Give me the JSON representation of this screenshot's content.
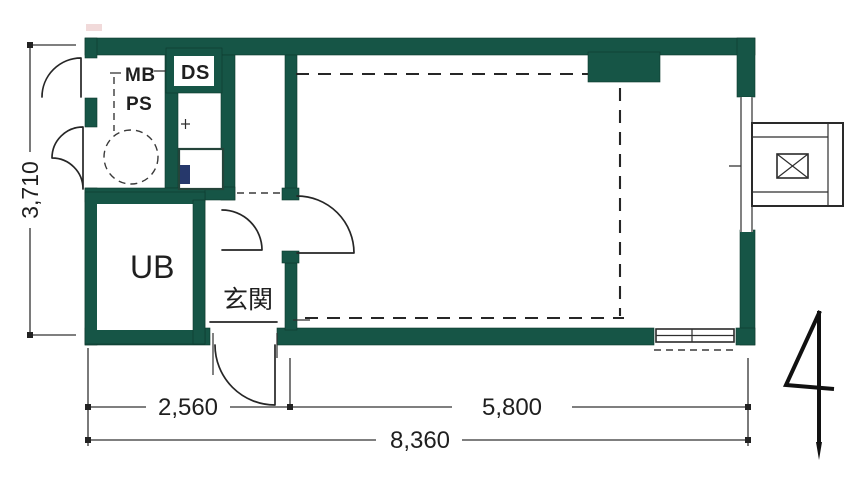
{
  "meta": {
    "type": "floor-plan",
    "description": "Scanned Japanese one-room apartment floor plan with green walls, dimension lines and north arrow"
  },
  "labels": {
    "meter_box": "MB",
    "pipe_space": "PS",
    "duct_space": "DS",
    "unit_bath": "UB",
    "entrance": "玄関"
  },
  "dimensions": {
    "left_height": "3,710",
    "bottom_left": "2,560",
    "bottom_right": "5,800",
    "bottom_total": "8,360"
  },
  "icons": {
    "north_arrow": "north-arrow",
    "ac_unit": "crossed-box",
    "toilet": "dashed-circle"
  },
  "colors": {
    "wall": "#165546",
    "line": "#262626",
    "fixture_accent": "#26386b",
    "background": "#ffffff"
  }
}
